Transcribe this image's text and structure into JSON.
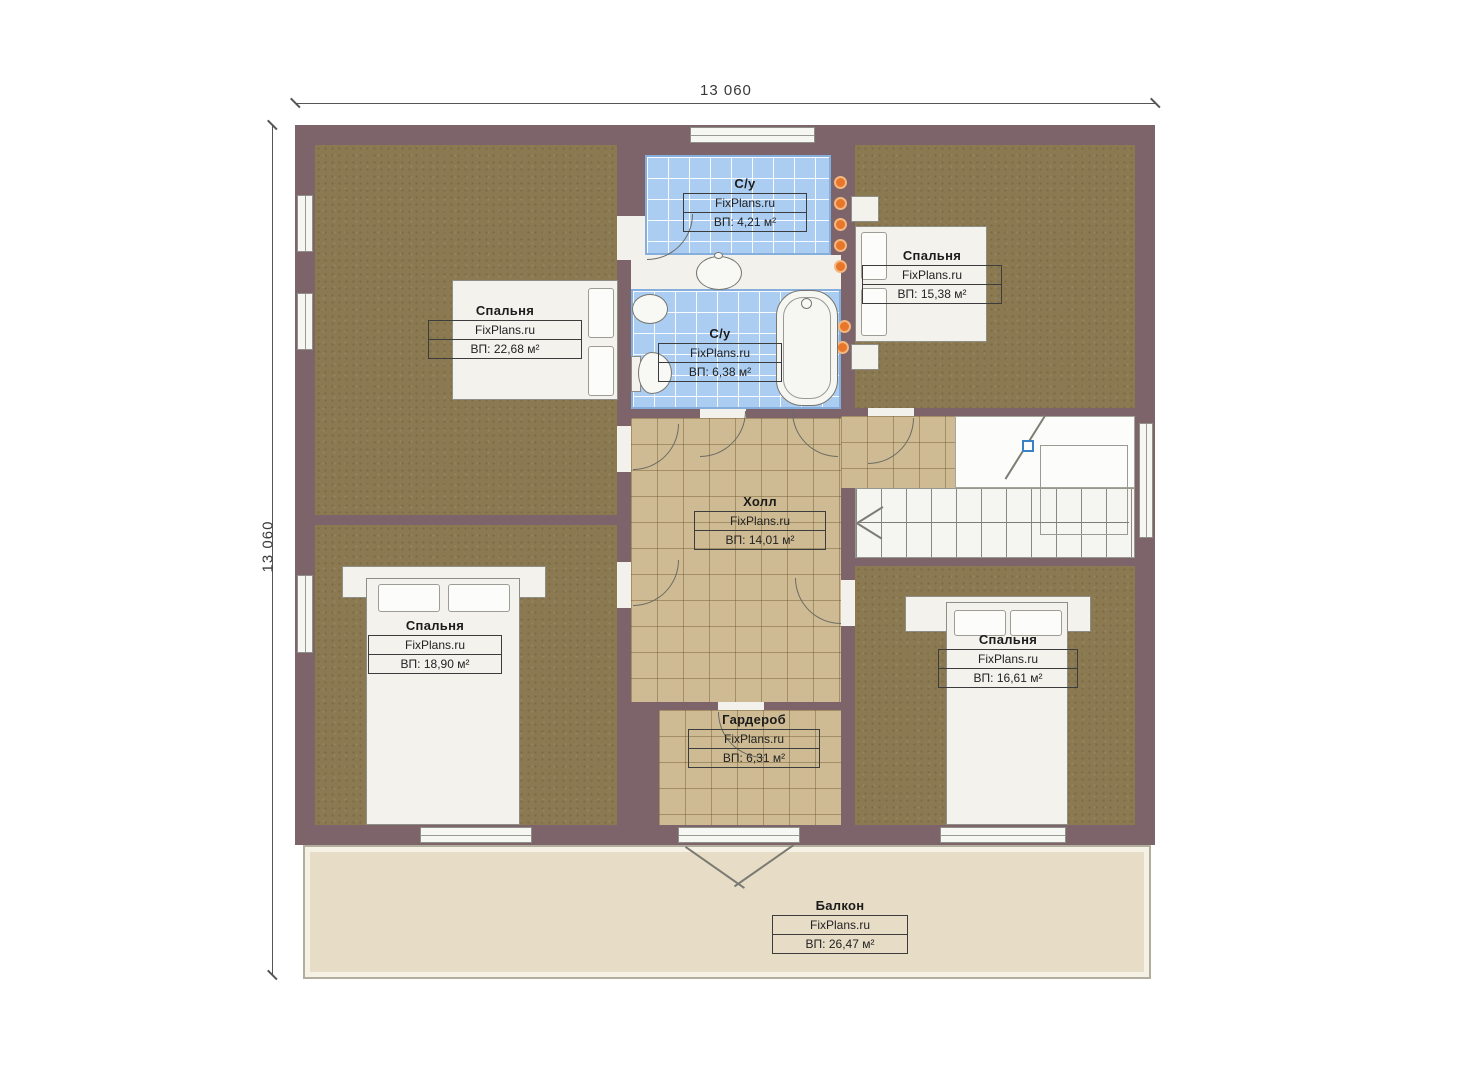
{
  "dim": {
    "top": "13 060",
    "left": "13 060"
  },
  "rooms": {
    "bedroom_top_left": {
      "name": "Спальня",
      "brand": "FixPlans.ru",
      "area": "ВП: 22,68 м²"
    },
    "bathroom_top": {
      "name": "С/у",
      "brand": "FixPlans.ru",
      "area": "ВП: 4,21 м²"
    },
    "bathroom_main": {
      "name": "С/у",
      "brand": "FixPlans.ru",
      "area": "ВП: 6,38 м²"
    },
    "bedroom_top_right": {
      "name": "Спальня",
      "brand": "FixPlans.ru",
      "area": "ВП: 15,38 м²"
    },
    "hall": {
      "name": "Холл",
      "brand": "FixPlans.ru",
      "area": "ВП: 14,01 м²"
    },
    "bedroom_bottom_left": {
      "name": "Спальня",
      "brand": "FixPlans.ru",
      "area": "ВП: 18,90 м²"
    },
    "bedroom_bottom_right": {
      "name": "Спальня",
      "brand": "FixPlans.ru",
      "area": "ВП: 16,61 м²"
    },
    "wardrobe": {
      "name": "Гардероб",
      "brand": "FixPlans.ru",
      "area": "ВП: 6,31 м²"
    },
    "balcony": {
      "name": "Балкон",
      "brand": "FixPlans.ru",
      "area": "ВП: 26,47 м²"
    }
  },
  "colors": {
    "wall": "#7c646a",
    "bedroom_floor": "#8a7951",
    "hall_floor": "#cfbb93",
    "bath_floor": "#abcdf1",
    "balcony_floor": "#e7dcc6",
    "dot": "#e8762b",
    "marker": "#3b82c4"
  }
}
